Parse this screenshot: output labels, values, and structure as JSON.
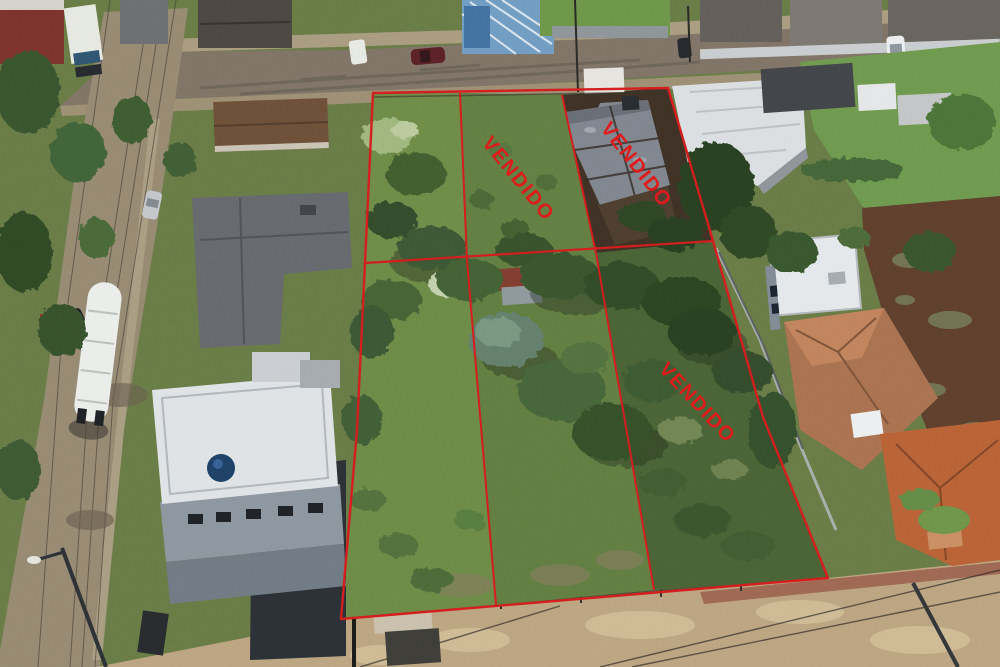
{
  "labels": {
    "sold": "VENDIDO"
  },
  "lots": [
    {
      "id": "top-left",
      "label": ""
    },
    {
      "id": "top-middle",
      "label": "VENDIDO"
    },
    {
      "id": "top-right",
      "label": "VENDIDO"
    },
    {
      "id": "bottom-left",
      "label": ""
    },
    {
      "id": "bottom-middle",
      "label": ""
    },
    {
      "id": "bottom-right",
      "label": "VENDIDO"
    }
  ],
  "colors": {
    "boundary_red": "#d92121",
    "sold_text_red": "#e31d1d"
  }
}
